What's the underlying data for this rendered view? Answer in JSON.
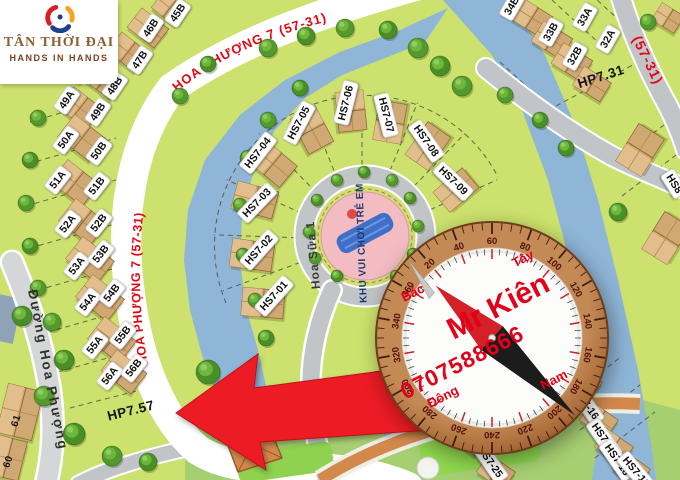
{
  "logo": {
    "title": "TÂN THỜI ĐẠI",
    "subtitle": "HANDS IN HANDS"
  },
  "streets": {
    "top_curve": "HOA PHƯỢNG 7 (57-31)",
    "left_curve": "HOA PHƯỢNG 7 (57-31)",
    "right_short": "(57-31)",
    "left_road": "Đường Hoa Phượng",
    "center_road": "Hoa Sữa 1"
  },
  "playground": {
    "label": "KHU VUI CHƠI TRẺ EM"
  },
  "compass": {
    "name": "Mr Kiên",
    "phone": "0707588666",
    "north": "Bắc",
    "west": "Tây",
    "east": "Đông",
    "south": "Nam",
    "degrees": [
      20,
      40,
      60,
      80,
      100,
      120,
      140,
      160,
      180,
      200,
      220,
      240,
      260,
      280,
      300,
      320,
      340,
      360
    ]
  },
  "colors": {
    "lot_green": "#cde26e",
    "park_green": "#a6cf72",
    "water": "#8fb5d8",
    "road": "#c2c5c8",
    "red_text": "#e30613",
    "arrow_red": "#ed1c24",
    "playground_pink": "#f2bcc2",
    "compass_copper": "#b17142",
    "compass_red": "#e2001a"
  },
  "map": {
    "lots": [
      {
        "label": "45B",
        "x": 178,
        "y": 13,
        "r": -56
      },
      {
        "label": "46B",
        "x": 151,
        "y": 28,
        "r": -56
      },
      {
        "label": "47B",
        "x": 140,
        "y": 60,
        "r": -56
      },
      {
        "label": "48A",
        "x": 80,
        "y": 70,
        "r": -56
      },
      {
        "label": "48B",
        "x": 115,
        "y": 86,
        "r": -56
      },
      {
        "label": "49A",
        "x": 67,
        "y": 100,
        "r": -56
      },
      {
        "label": "49B",
        "x": 98,
        "y": 112,
        "r": -56
      },
      {
        "label": "50A",
        "x": 66,
        "y": 140,
        "r": -54
      },
      {
        "label": "50B",
        "x": 99,
        "y": 151,
        "r": -54
      },
      {
        "label": "51A",
        "x": 58,
        "y": 180,
        "r": -52
      },
      {
        "label": "51B",
        "x": 97,
        "y": 186,
        "r": -52
      },
      {
        "label": "52A",
        "x": 68,
        "y": 224,
        "r": -52
      },
      {
        "label": "52B",
        "x": 99,
        "y": 223,
        "r": -52
      },
      {
        "label": "53A",
        "x": 77,
        "y": 266,
        "r": -52
      },
      {
        "label": "53B",
        "x": 101,
        "y": 254,
        "r": -52
      },
      {
        "label": "54A",
        "x": 88,
        "y": 302,
        "r": -52
      },
      {
        "label": "54B",
        "x": 112,
        "y": 293,
        "r": -52
      },
      {
        "label": "55A",
        "x": 95,
        "y": 345,
        "r": -52
      },
      {
        "label": "55B",
        "x": 123,
        "y": 335,
        "r": -52
      },
      {
        "label": "56A",
        "x": 110,
        "y": 376,
        "r": -52
      },
      {
        "label": "56B",
        "x": 134,
        "y": 368,
        "r": -52
      },
      {
        "label": "HP7.57",
        "x": 131,
        "y": 411,
        "r": -14,
        "plain": true
      },
      {
        "label": "34B",
        "x": 512,
        "y": 6,
        "r": -60
      },
      {
        "label": "33B",
        "x": 551,
        "y": 32,
        "r": -60
      },
      {
        "label": "33A",
        "x": 585,
        "y": 17,
        "r": -60
      },
      {
        "label": "32B",
        "x": 575,
        "y": 56,
        "r": -60
      },
      {
        "label": "32A",
        "x": 608,
        "y": 39,
        "r": -60
      },
      {
        "label": "HP7.31",
        "x": 601,
        "y": 77,
        "r": -18,
        "plain": true
      },
      {
        "label": "HS8",
        "x": 674,
        "y": 184,
        "r": 58
      },
      {
        "label": "HS7-01",
        "x": 274,
        "y": 296,
        "r": -48
      },
      {
        "label": "HS7-02",
        "x": 259,
        "y": 250,
        "r": -48
      },
      {
        "label": "HS7-03",
        "x": 257,
        "y": 203,
        "r": -46
      },
      {
        "label": "HS7-04",
        "x": 258,
        "y": 153,
        "r": -52
      },
      {
        "label": "HS7-05",
        "x": 299,
        "y": 123,
        "r": -62
      },
      {
        "label": "HS7-06",
        "x": 346,
        "y": 103,
        "r": -76
      },
      {
        "label": "HS7-07",
        "x": 386,
        "y": 115,
        "r": 76
      },
      {
        "label": "HS7-08",
        "x": 426,
        "y": 141,
        "r": 55
      },
      {
        "label": "HS7-09",
        "x": 453,
        "y": 181,
        "r": 44
      },
      {
        "label": "HS7-16",
        "x": 586,
        "y": 404,
        "r": 55
      },
      {
        "label": "HS7-17",
        "x": 604,
        "y": 439,
        "r": 55
      },
      {
        "label": "HS7-18",
        "x": 617,
        "y": 460,
        "r": 55
      },
      {
        "label": "HS7-19",
        "x": 636,
        "y": 472,
        "r": 50
      },
      {
        "label": "HS7-25",
        "x": 490,
        "y": 462,
        "r": 55
      },
      {
        "label": "61",
        "x": 17,
        "y": 421,
        "r": -72,
        "plain": true,
        "small": true
      },
      {
        "label": "60",
        "x": 9,
        "y": 462,
        "r": -72,
        "plain": true,
        "small": true
      }
    ],
    "houses": [
      [
        170,
        8,
        30,
        22,
        38
      ],
      [
        148,
        28,
        34,
        24,
        38
      ],
      [
        128,
        52,
        34,
        24,
        38
      ],
      [
        104,
        80,
        34,
        24,
        38
      ],
      [
        80,
        108,
        36,
        26,
        38
      ],
      [
        82,
        138,
        40,
        28,
        38
      ],
      [
        75,
        183,
        40,
        28,
        38
      ],
      [
        83,
        222,
        40,
        28,
        38
      ],
      [
        90,
        260,
        40,
        28,
        38
      ],
      [
        100,
        298,
        40,
        28,
        38
      ],
      [
        112,
        340,
        40,
        28,
        38
      ],
      [
        124,
        372,
        38,
        26,
        38
      ],
      [
        532,
        18,
        34,
        24,
        32
      ],
      [
        552,
        40,
        34,
        24,
        32
      ],
      [
        572,
        62,
        34,
        24,
        32
      ],
      [
        592,
        84,
        32,
        22,
        32
      ],
      [
        668,
        18,
        26,
        20,
        32
      ],
      [
        640,
        150,
        44,
        30,
        -58
      ],
      [
        666,
        238,
        44,
        30,
        -58
      ],
      [
        255,
        200,
        42,
        28,
        15
      ],
      [
        252,
        255,
        42,
        28,
        8
      ],
      [
        263,
        303,
        42,
        28,
        5
      ],
      [
        273,
        164,
        40,
        28,
        40
      ],
      [
        312,
        130,
        40,
        28,
        62
      ],
      [
        351,
        111,
        40,
        28,
        84
      ],
      [
        390,
        122,
        40,
        28,
        -80
      ],
      [
        428,
        146,
        40,
        28,
        -55
      ],
      [
        456,
        190,
        38,
        26,
        -40
      ],
      [
        583,
        382,
        32,
        22,
        35
      ],
      [
        599,
        420,
        32,
        22,
        35
      ],
      [
        614,
        447,
        32,
        22,
        35
      ],
      [
        631,
        469,
        32,
        22,
        35
      ],
      [
        468,
        438,
        32,
        22,
        35
      ],
      [
        496,
        472,
        32,
        22,
        35
      ],
      [
        20,
        412,
        36,
        50,
        14
      ],
      [
        8,
        458,
        30,
        40,
        14
      ]
    ],
    "trees": [
      [
        268,
        48,
        9
      ],
      [
        306,
        36,
        9
      ],
      [
        345,
        28,
        9
      ],
      [
        388,
        30,
        9
      ],
      [
        418,
        48,
        10
      ],
      [
        440,
        66,
        10
      ],
      [
        462,
        86,
        10
      ],
      [
        208,
        64,
        8
      ],
      [
        180,
        96,
        8
      ],
      [
        300,
        88,
        8
      ],
      [
        268,
        120,
        8
      ],
      [
        248,
        158,
        8
      ],
      [
        240,
        205,
        7
      ],
      [
        243,
        255,
        7
      ],
      [
        255,
        300,
        7
      ],
      [
        266,
        338,
        8
      ],
      [
        38,
        118,
        8
      ],
      [
        30,
        160,
        8
      ],
      [
        26,
        203,
        8
      ],
      [
        30,
        246,
        8
      ],
      [
        38,
        288,
        8
      ],
      [
        22,
        316,
        10
      ],
      [
        52,
        322,
        9
      ],
      [
        64,
        360,
        10
      ],
      [
        44,
        396,
        10
      ],
      [
        74,
        434,
        11
      ],
      [
        112,
        456,
        10
      ],
      [
        148,
        462,
        9
      ],
      [
        309,
        232,
        6
      ],
      [
        317,
        200,
        6
      ],
      [
        337,
        180,
        6
      ],
      [
        364,
        172,
        6
      ],
      [
        392,
        180,
        6
      ],
      [
        410,
        198,
        6
      ],
      [
        418,
        226,
        6
      ],
      [
        413,
        254,
        6
      ],
      [
        396,
        276,
        6
      ],
      [
        337,
        276,
        6
      ],
      [
        315,
        258,
        6
      ],
      [
        208,
        372,
        12
      ],
      [
        237,
        384,
        12
      ],
      [
        265,
        402,
        12
      ],
      [
        350,
        408,
        12
      ],
      [
        378,
        382,
        11
      ],
      [
        428,
        384,
        11
      ],
      [
        618,
        212,
        9
      ],
      [
        505,
        95,
        8
      ],
      [
        540,
        120,
        8
      ],
      [
        648,
        22,
        8
      ],
      [
        566,
        148,
        8
      ]
    ]
  }
}
